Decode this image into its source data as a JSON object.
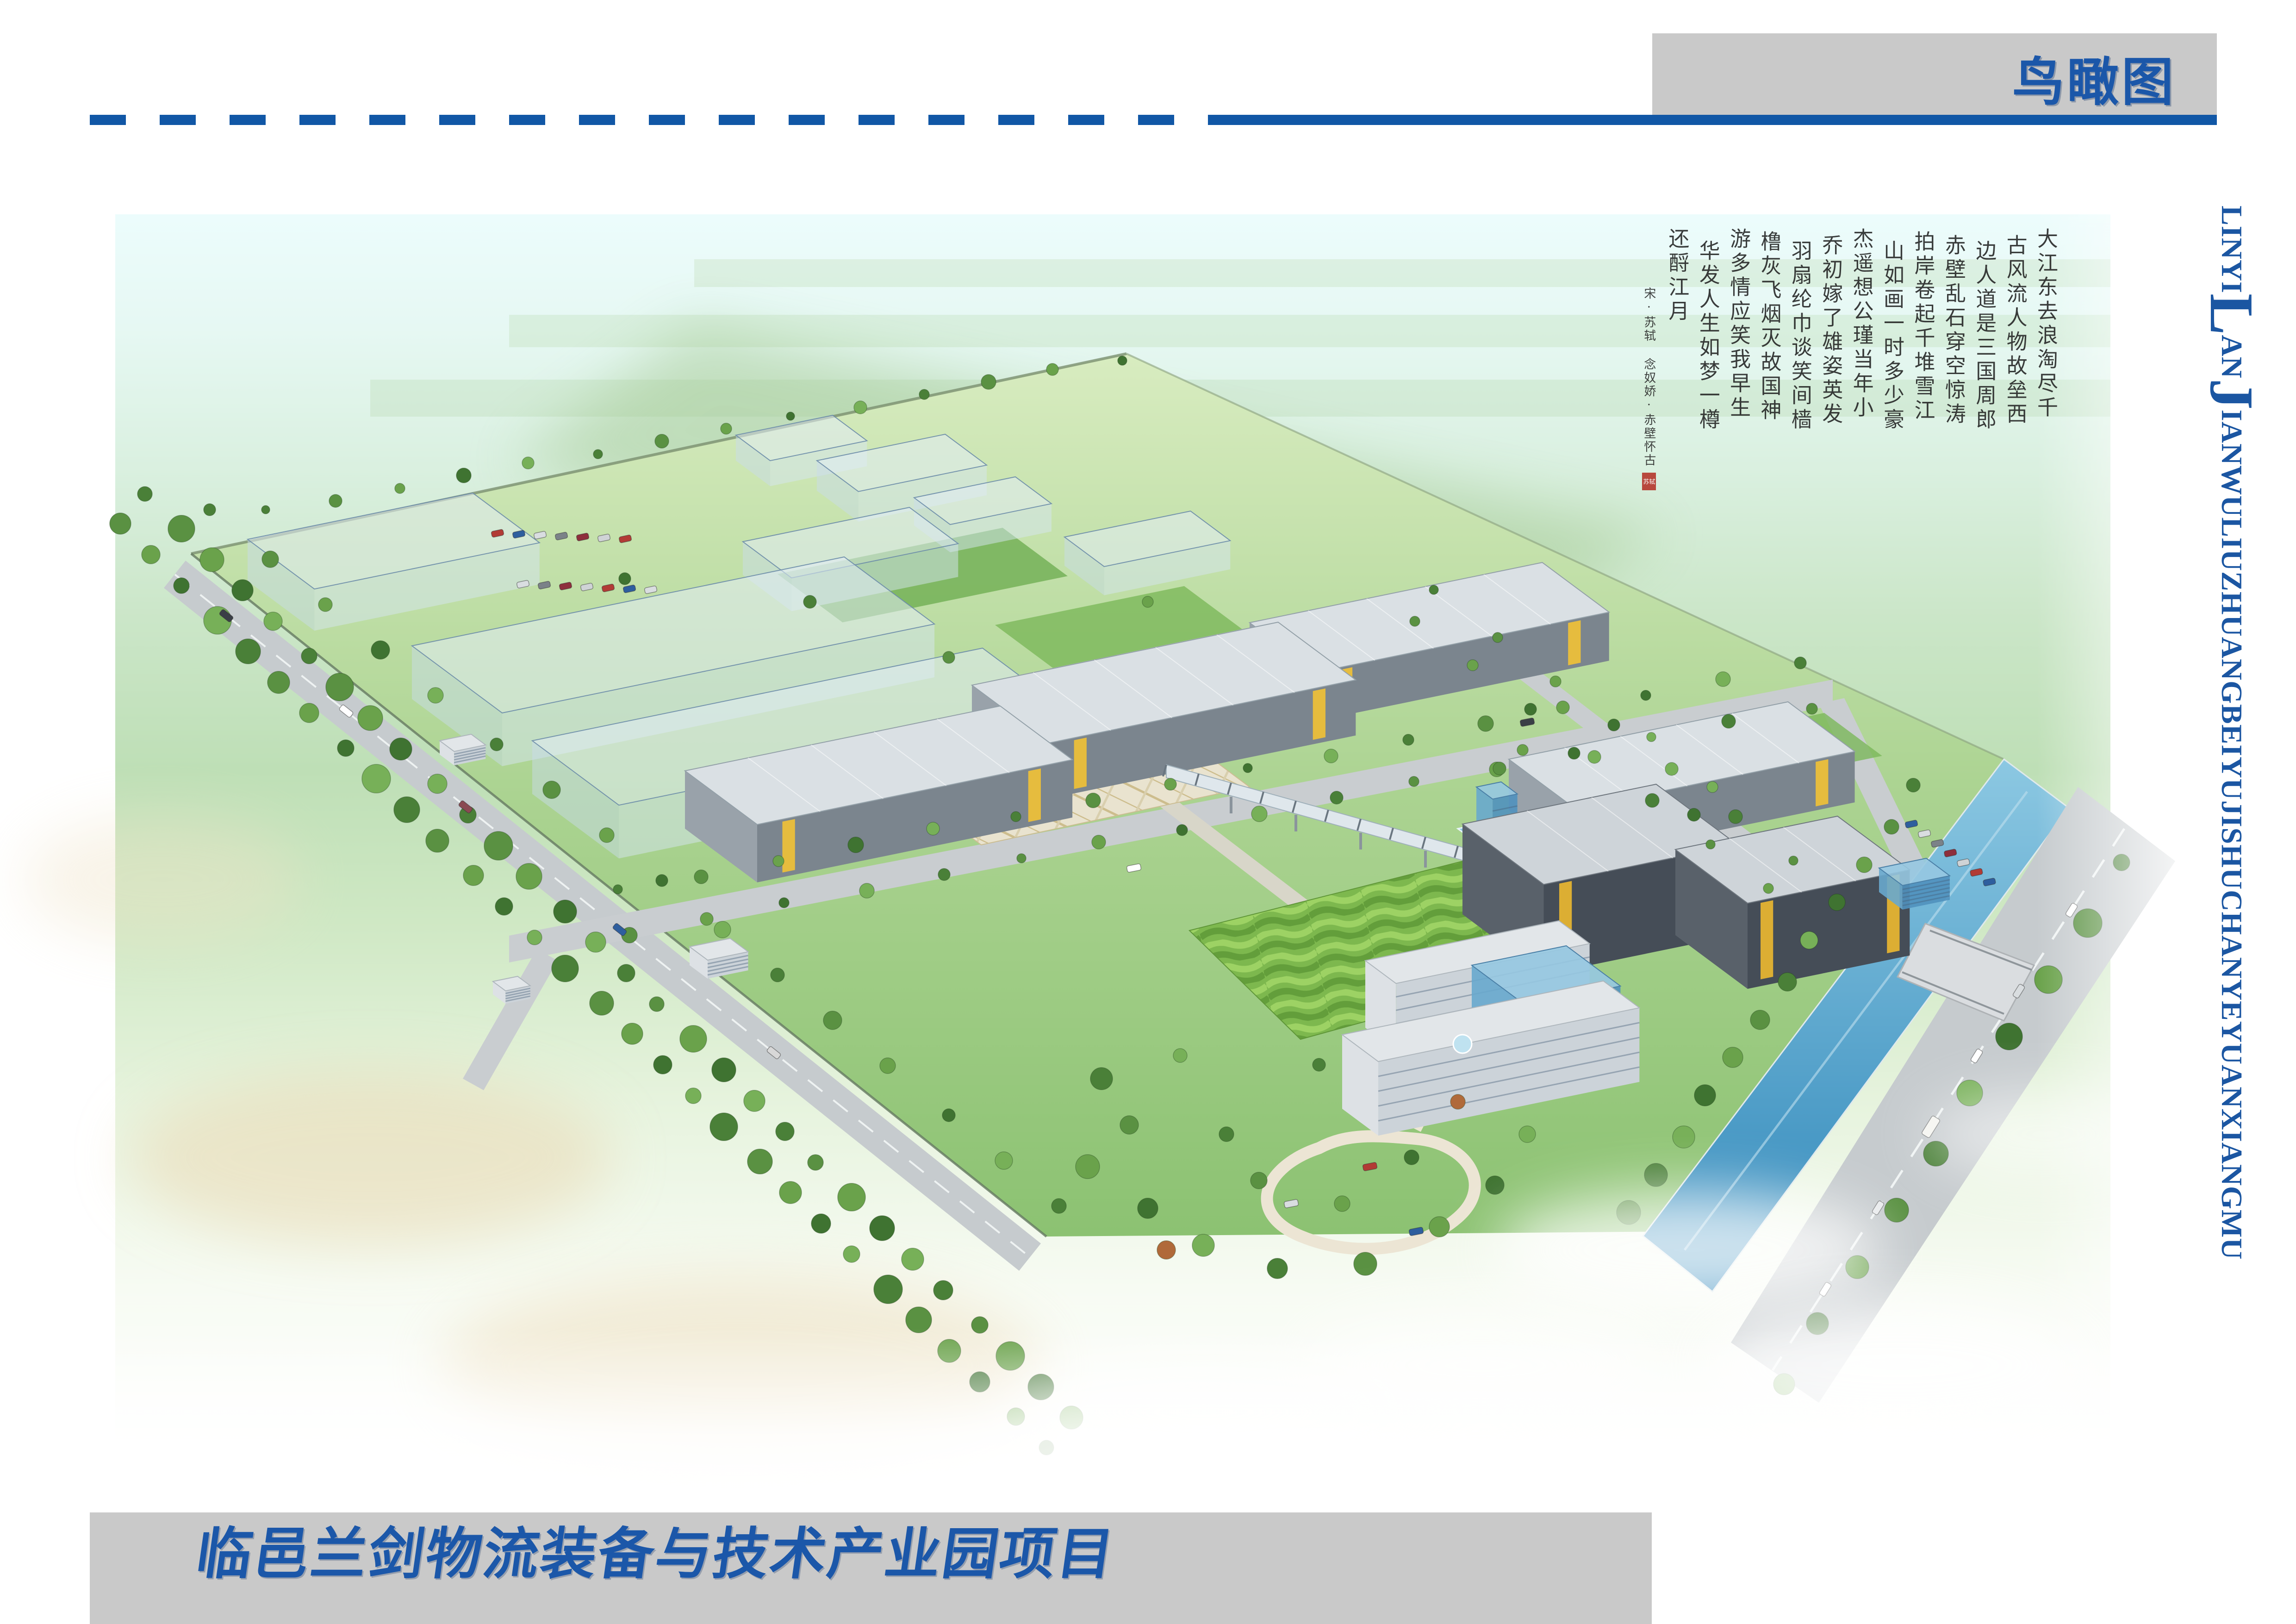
{
  "header": {
    "section_label": "鸟瞰图"
  },
  "footer": {
    "project_title": "临邑兰剑物流装备与技术产业园项目"
  },
  "side_text": {
    "full": "LINYILANJIANWULIUZHUANGBEIYUJISHUCHANYEYUANXIANGMU",
    "segments": [
      "LINYI",
      "L",
      "AN",
      "J",
      "IANWULIUZHUANGBEIYUJISHUCHANYEYUANXIANGMU"
    ]
  },
  "calligraphy": {
    "title": "念奴娇·赤壁怀古",
    "columns": [
      "大江东去浪淘尽千",
      "古风流人物故垒西",
      "边人道是三国周郎",
      "赤壁乱石穿空惊涛",
      "拍岸卷起千堆雪江",
      "山如画一时多少豪",
      "杰遥想公瑾当年小",
      "乔初嫁了雄姿英发",
      "羽扇纶巾谈笑间樯",
      "橹灰飞烟灭故国神",
      "游多情应笑我早生",
      "华发人生如梦一樽",
      "还酹江月"
    ],
    "signature": "宋·苏轼 念奴娇·赤壁怀古",
    "seal_text": "苏轼"
  },
  "render": {
    "colors": {
      "accent_blue": "#1b57a9",
      "bar_gray": "#c9c9c9",
      "sky": "#eafafa",
      "field_green": "#c2e0bd",
      "lawn_green": "#7db84e",
      "roof_gray": "#dae0e4",
      "dark_wall": "#454d57",
      "accent_yellow": "#e6bc3e",
      "tree_green": "#4a8038",
      "water_blue": "#2f87ba",
      "seal_red": "#b5372c"
    }
  }
}
